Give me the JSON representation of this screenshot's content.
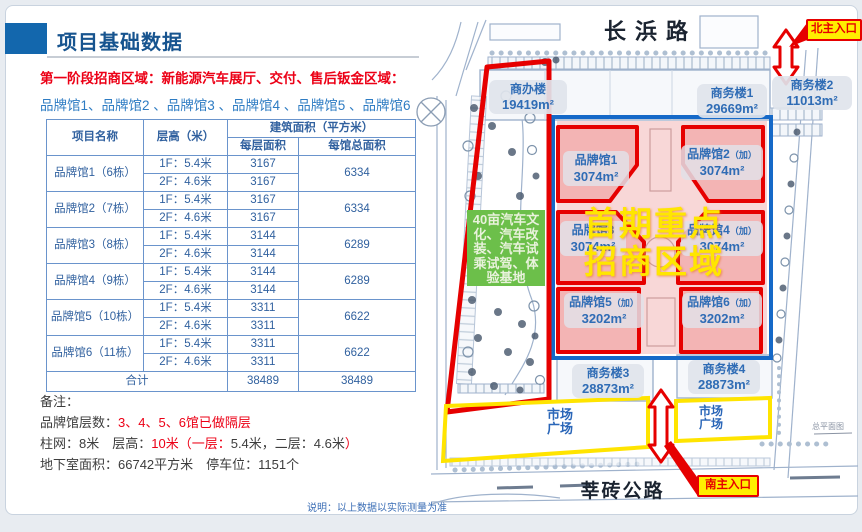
{
  "header": {
    "title": "项目基础数据"
  },
  "intro": {
    "phase_line": "第一阶段招商区域：新能源汽车展厅、交付、售后钣金区域：",
    "halls_line": "品牌馆1、品牌馆2 、品牌馆3 、品牌馆4 、品牌馆5 、品牌馆6"
  },
  "table": {
    "headers": {
      "name": "项目名称",
      "height": "层高（米）",
      "area_group": "建筑面积（平方米）",
      "floor_area": "每层面积",
      "total_area": "每馆总面积"
    },
    "rows": [
      {
        "name": "品牌馆1（6栋）",
        "floors": [
          {
            "h": "1F：5.4米",
            "a": "3167"
          },
          {
            "h": "2F：4.6米",
            "a": "3167"
          }
        ],
        "total": "6334"
      },
      {
        "name": "品牌馆2（7栋）",
        "floors": [
          {
            "h": "1F：5.4米",
            "a": "3167"
          },
          {
            "h": "2F：4.6米",
            "a": "3167"
          }
        ],
        "total": "6334"
      },
      {
        "name": "品牌馆3（8栋）",
        "floors": [
          {
            "h": "1F：5.4米",
            "a": "3144"
          },
          {
            "h": "2F：4.6米",
            "a": "3144"
          }
        ],
        "total": "6289"
      },
      {
        "name": "品牌馆4（9栋）",
        "floors": [
          {
            "h": "1F：5.4米",
            "a": "3144"
          },
          {
            "h": "2F：4.6米",
            "a": "3144"
          }
        ],
        "total": "6289"
      },
      {
        "name": "品牌馆5（10栋）",
        "floors": [
          {
            "h": "1F：5.4米",
            "a": "3311"
          },
          {
            "h": "2F：4.6米",
            "a": "3311"
          }
        ],
        "total": "6622"
      },
      {
        "name": "品牌馆6（11栋）",
        "floors": [
          {
            "h": "1F：5.4米",
            "a": "3311"
          },
          {
            "h": "2F：4.6米",
            "a": "3311"
          }
        ],
        "total": "6622"
      }
    ],
    "total_row": {
      "label": "合计",
      "floor_sum": "38489",
      "total_sum": "38489"
    }
  },
  "notes": {
    "label": "备注：",
    "floors_prefix": "品牌馆层数：",
    "floors_red": "3、4、5、6馆已做隔层",
    "structure_parts": [
      {
        "text": "柱网：8米　层高：",
        "red": false
      },
      {
        "text": "10米",
        "red": true
      },
      {
        "text": "（一层：",
        "red": true
      },
      {
        "text": "5.4米，二层：4.6米",
        "red": false
      },
      {
        "text": "）",
        "red": true
      }
    ],
    "basement": "地下室面积：66742平方米　停车位：1151个"
  },
  "footnote": "说明：以上数据以实际测量为准",
  "map": {
    "roads": {
      "top": "长浜路",
      "bottom": "莘砖公路"
    },
    "entrances": {
      "north": "北主入口",
      "south": "南主入口"
    },
    "office_buildings": [
      {
        "name": "商办楼",
        "area": "19419m²"
      },
      {
        "name": "商务楼1",
        "area": "29669m²"
      },
      {
        "name": "商务楼2",
        "area": "11013m²"
      },
      {
        "name": "商务楼3",
        "area": "28873m²"
      },
      {
        "name": "商务楼4",
        "area": "28873m²"
      }
    ],
    "pavilions": [
      {
        "name": "品牌馆1",
        "suffix": "",
        "area": "3074m²"
      },
      {
        "name": "品牌馆2",
        "suffix": "（加）",
        "area": "3074m²"
      },
      {
        "name": "品牌馆3",
        "suffix": "",
        "area": "3074m²"
      },
      {
        "name": "品牌馆4",
        "suffix": "（加）",
        "area": "3074m²"
      },
      {
        "name": "品牌馆5",
        "suffix": "（加）",
        "area": "3202m²"
      },
      {
        "name": "品牌馆6",
        "suffix": "（加）",
        "area": "3202m²"
      }
    ],
    "highlight": {
      "line1": "首期重点",
      "line2": "招商区域"
    },
    "green_zone": "40亩汽车文化、汽车改装、汽车试乘试驾、体验基地",
    "plazas": [
      {
        "line1": "市场",
        "line2": "广场"
      },
      {
        "line1": "市场",
        "line2": "广场"
      }
    ],
    "caption": "总平面图"
  },
  "colors": {
    "accent_red": "#e60000",
    "boundary_blue": "#1569c8",
    "entrance_yellow": "#ffee00",
    "green_zone": "#6cbf4a",
    "title_blue": "#1367ad",
    "text_blue": "#2f6cb5",
    "pink_fill": "#f2b0b0"
  }
}
